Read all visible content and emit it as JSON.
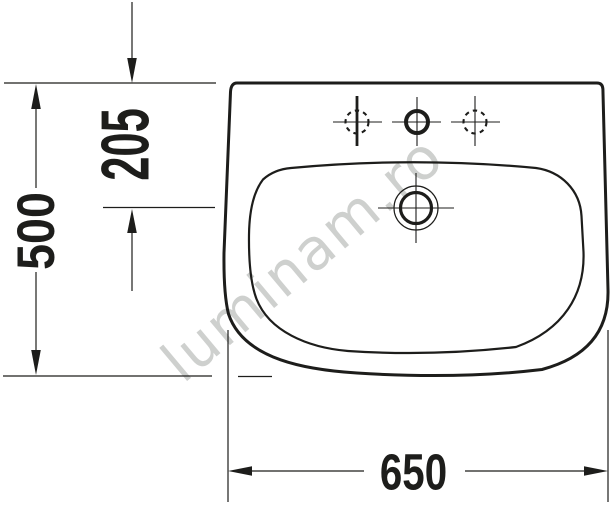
{
  "drawing": {
    "title": "Washbasin technical drawing",
    "watermark": "luminam.ro",
    "dim_depth": "500",
    "dim_tap_offset": "205",
    "dim_width": "650"
  },
  "colors": {
    "line": "#1d1d1b",
    "text": "#1d1d1b",
    "watermark": "#c9cbc9",
    "background": "#ffffff"
  }
}
